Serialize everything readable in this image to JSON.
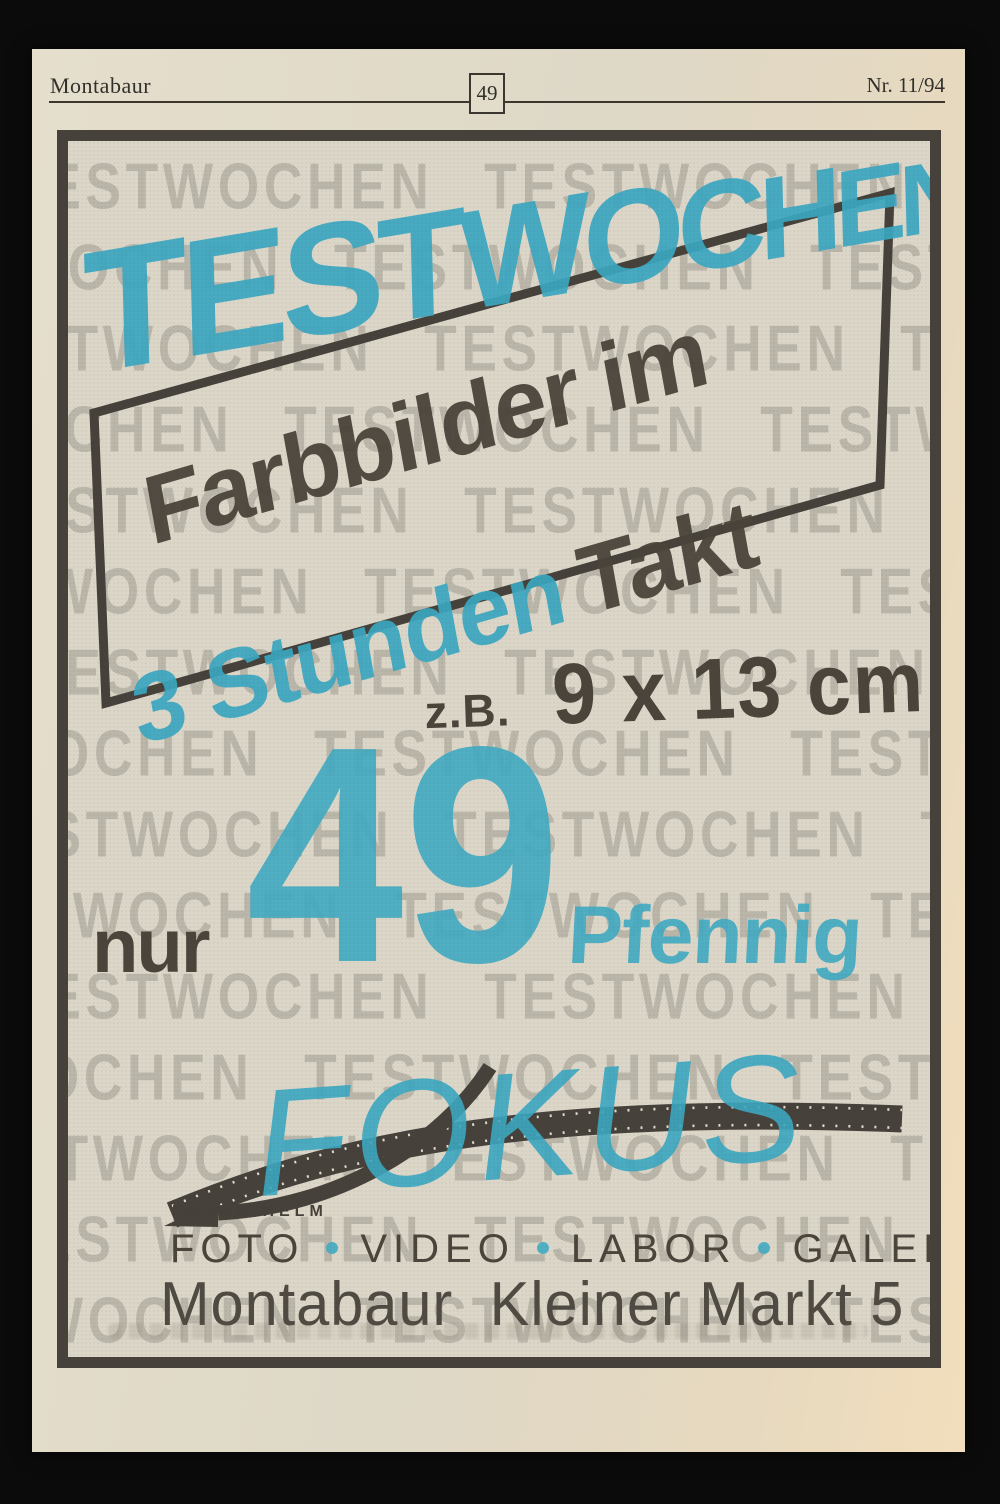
{
  "header": {
    "section": "Montabaur",
    "page_number": "49",
    "issue": "Nr. 11/94"
  },
  "ad": {
    "watermark_word": "TESTWOCHEN",
    "hero_title": "TESTWOCHEN",
    "line1": "Farbbilder im",
    "line2_accent": "3 Stunden",
    "line2_dark": "Takt",
    "example_prefix": "z.B.",
    "example_size": "9 x 13 cm",
    "price_prefix": "nur",
    "price_value": "49",
    "price_unit": "Pfennig",
    "logo": {
      "brand": "FOKUS",
      "owner": "FRANK HELM",
      "services": [
        "FOTO",
        "VIDEO",
        "LABOR",
        "GALERIE"
      ]
    },
    "address_city": "Montabaur",
    "address_street": "Kleiner Markt 5"
  },
  "colors": {
    "accent_cyan": "#3ba7c1",
    "ink_dark": "#4a443b",
    "paper": "#ddd7c7",
    "watermark_gray": "#b9b4ab"
  }
}
